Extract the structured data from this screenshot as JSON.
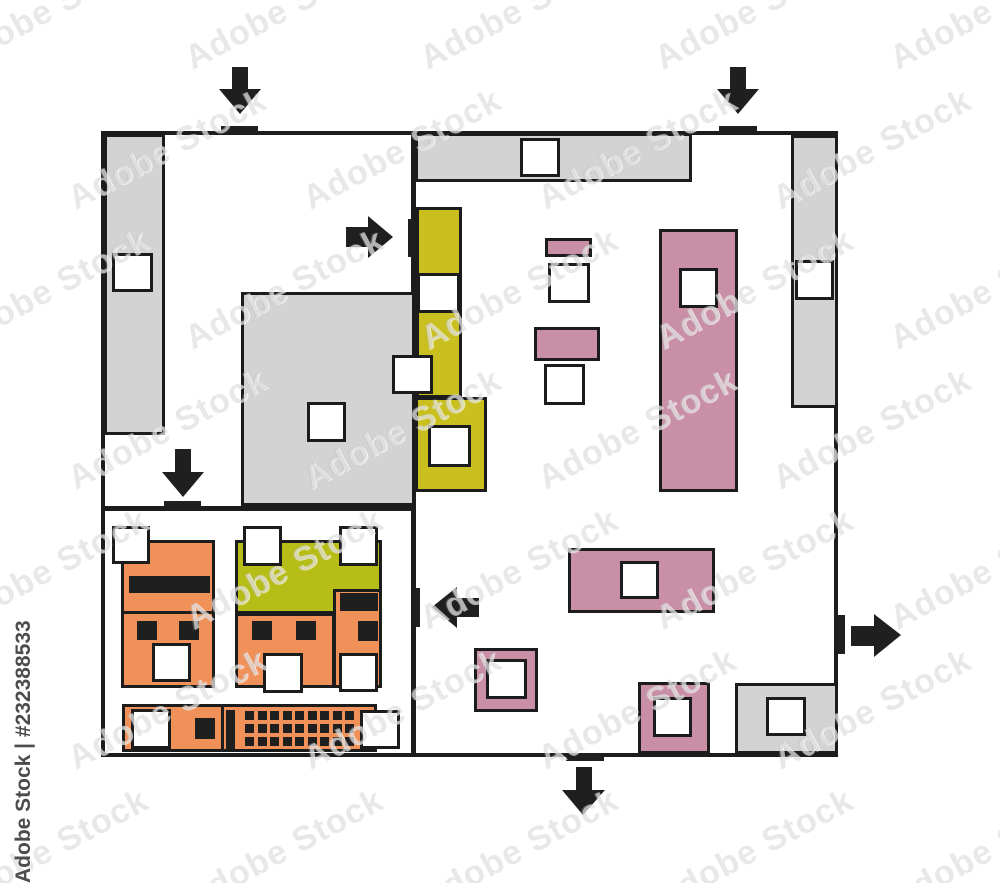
{
  "watermark": {
    "tile_text": "Adobe Stock",
    "stock_id_text": "Adobe Stock | #232388533"
  },
  "colors": {
    "wall_line": "#1c1c1c",
    "detail_black": "#1f1f1f",
    "gray_fixture": "#d3d3d3",
    "olive_fixture": "#c9c01f",
    "olive_fixture_alt": "#b7bd17",
    "pink_fixture": "#c98fa6",
    "orange_fixture": "#f0915a",
    "floor": "#ffffff"
  },
  "keyboard": {
    "rows": 3,
    "cols": 9,
    "key_px": 9
  },
  "watermark_grid": {
    "rows": 7,
    "cols": 5,
    "x_step": 235,
    "y_step": 140,
    "x_start": -60,
    "y_start": -10,
    "row_offset": 118
  }
}
